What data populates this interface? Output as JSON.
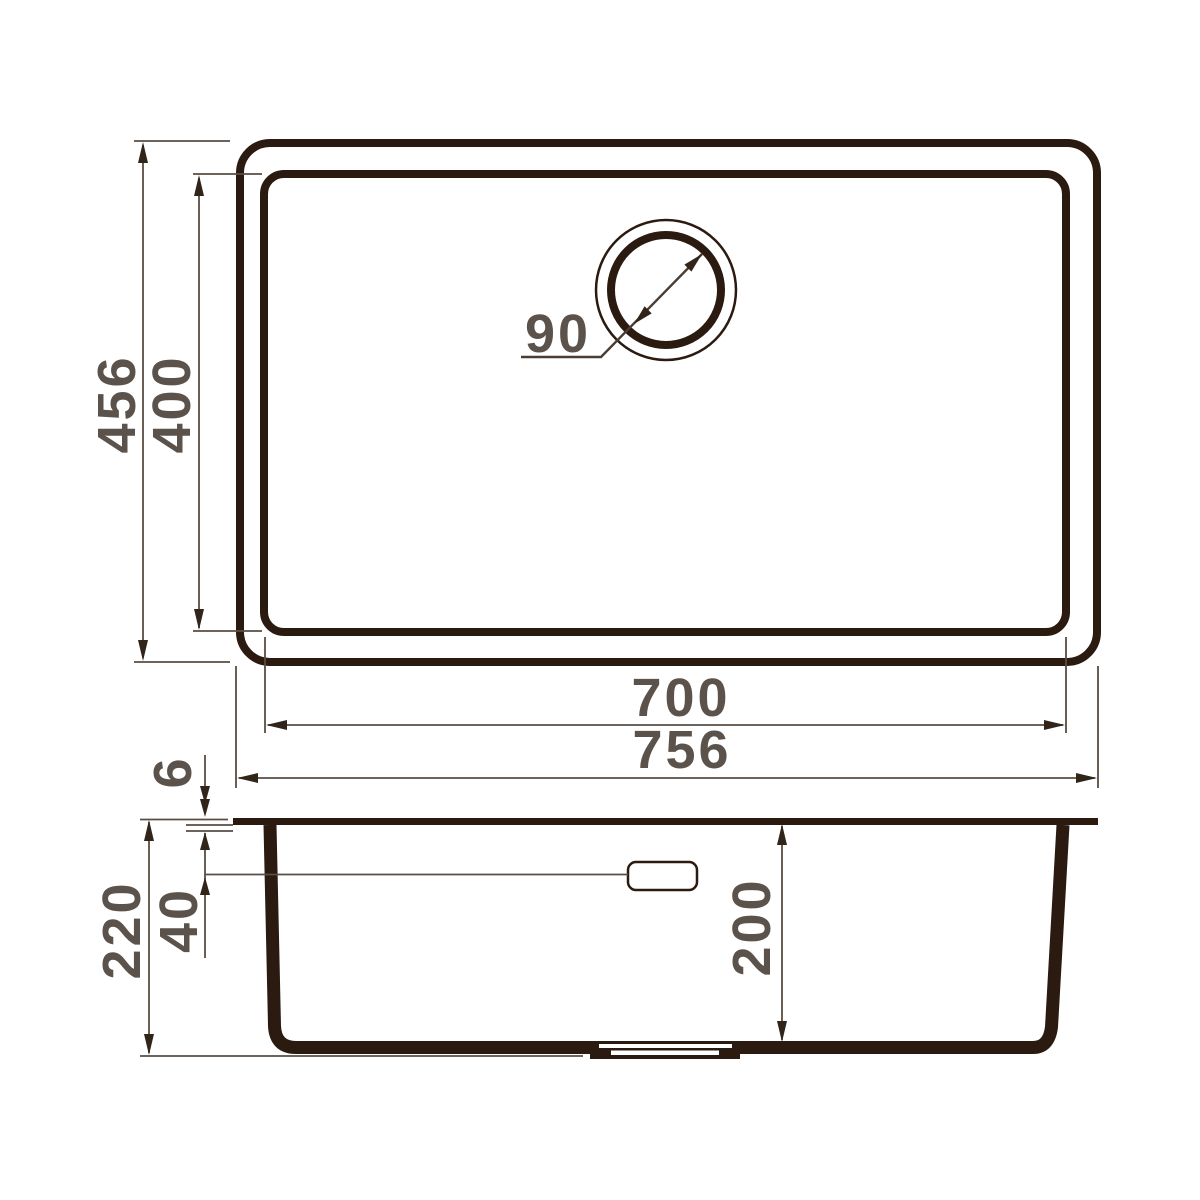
{
  "drawing": {
    "title": "Undermount sink technical dimension drawing",
    "colors": {
      "outline": "#2b1a10",
      "dimension_lines": "#5a4d42",
      "dimension_text": "#5b534b",
      "background": "#ffffff"
    },
    "dimensions": {
      "overall_length": "756",
      "bowl_length": "700",
      "overall_width": "456",
      "bowl_width": "400",
      "drain_diameter": "90",
      "rim_thickness": "6",
      "overflow_offset": "40",
      "overall_depth": "220",
      "bowl_depth": "200"
    }
  }
}
